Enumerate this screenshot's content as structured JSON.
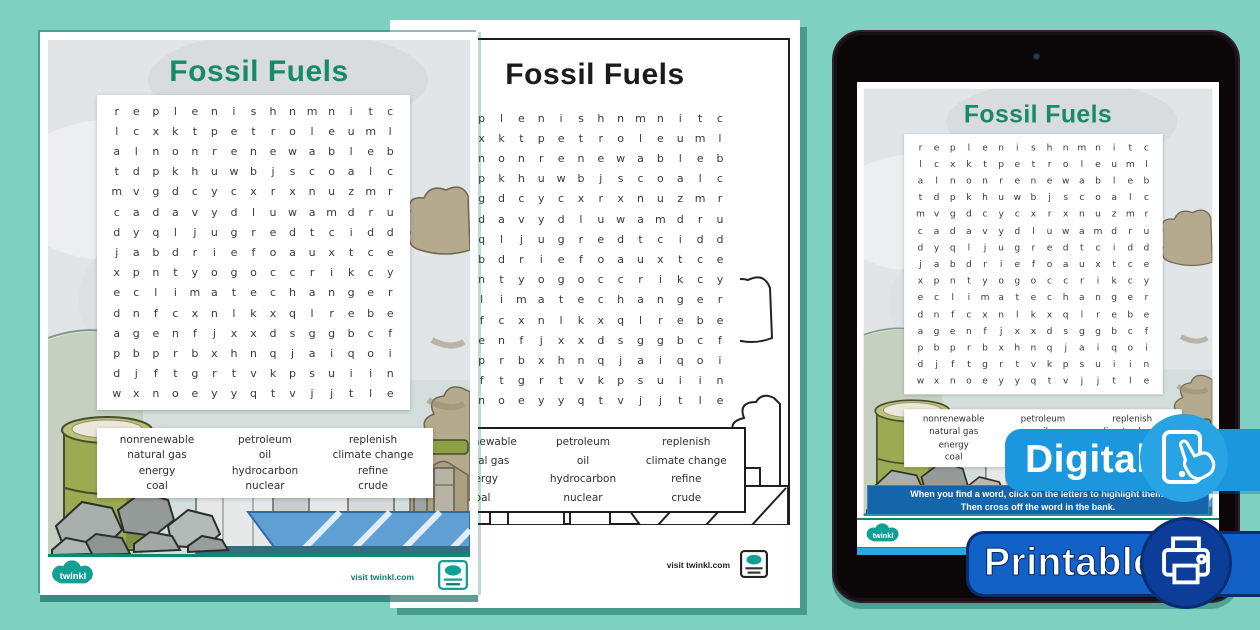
{
  "colors": {
    "bg": "#7ed0c1",
    "title-green": "#188a68",
    "bar-blue": "#1565ab",
    "cyan": "#2aa9dc",
    "digital-blue": "#1b97de",
    "digital-circle": "#28a3e4",
    "printable-blue": "#1261c6",
    "printable-navy": "#0a2c70",
    "printable-circle": "#0c3d99",
    "twinkl-teal": "#12a095"
  },
  "worksheet": {
    "title": "Fossil Fuels",
    "grid_rows": [
      "replenishnmnitc",
      "lcxktpetroleuml",
      "alnonrenewableb",
      "tdpkhuwbjscoalc",
      "mvgdcycxrxnuzmr",
      "cadavydluwamdru",
      "dyqljugredtcidd",
      "jabdriefoauxtce",
      "xpntyogoccrikcy",
      "eclimatechanger",
      "dnfcxnlkxqlrebe",
      "agenfjxxdsggbcf",
      "pbprbxhnqjaiqoi",
      "djftgrtvkpsuiin",
      "wxnoeyyqtvjjtle"
    ],
    "word_bank": {
      "columns": [
        [
          "nonrenewable",
          "natural gas",
          "energy",
          "coal"
        ],
        [
          "petroleum",
          "oil",
          "hydrocarbon",
          "nuclear"
        ],
        [
          "replenish",
          "climate change",
          "refine",
          "crude"
        ]
      ]
    },
    "footer": {
      "visit_text": "visit twinkl.com",
      "logo_text": "twinkl"
    }
  },
  "tablet": {
    "instruction_line1": "When you find a word, click on the letters to highlight them.",
    "instruction_line2": "Then cross off the word in the bank."
  },
  "badges": {
    "digital": "Digital",
    "printable": "Printable"
  }
}
